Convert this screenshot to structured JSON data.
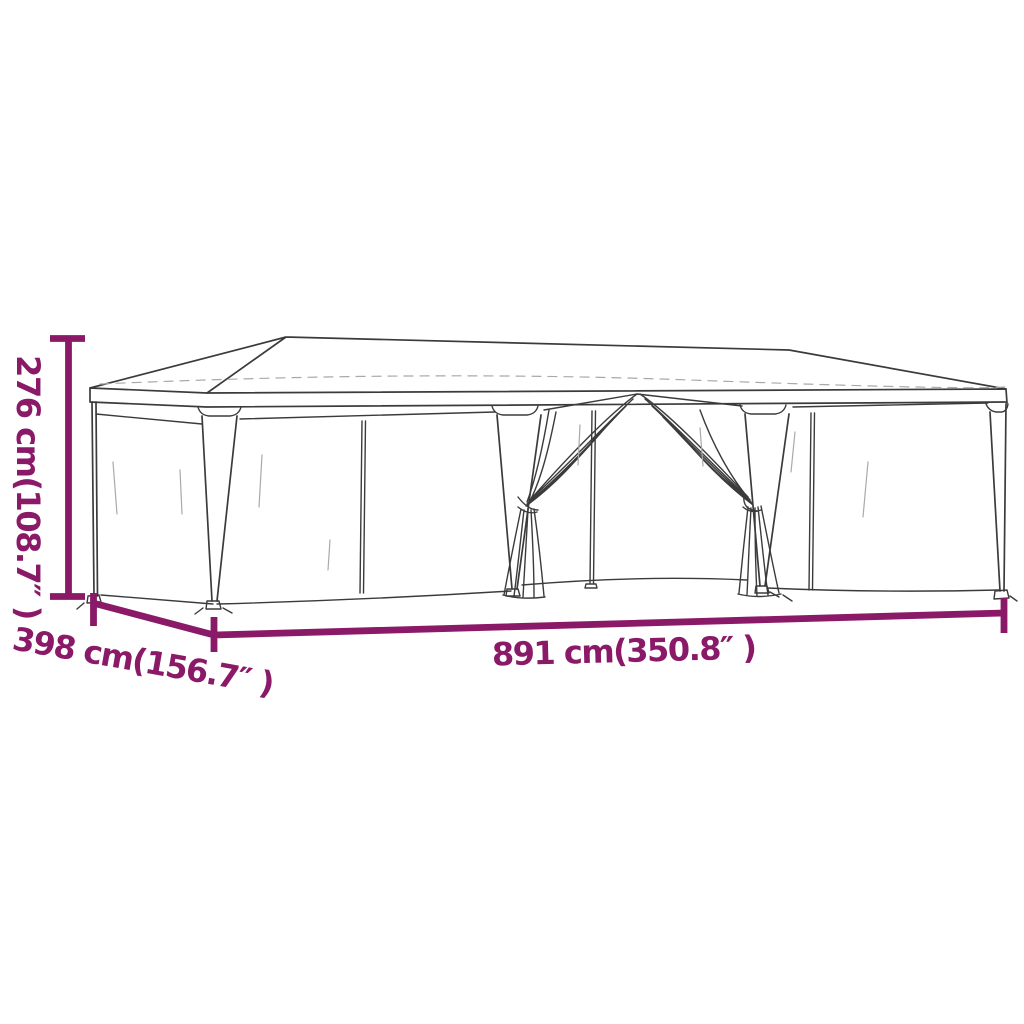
{
  "image": {
    "subject": "party tent with mesh sidewalls, tied-open center curtains — dimension diagram",
    "background": "#ffffff"
  },
  "colors": {
    "dimension": "#8a1a68",
    "tent_line": "#3b3b3b",
    "tent_faint": "#a9a9a9"
  },
  "dimensions": {
    "height": {
      "label": "276 cm(108.7″ )",
      "cm": "276",
      "inches": "108.7"
    },
    "depth": {
      "label": "398 cm(156.7″ )",
      "cm": "398",
      "inches": "156.7"
    },
    "width": {
      "label": "891 cm(350.8″ )",
      "cm": "891",
      "inches": "350.8"
    }
  }
}
